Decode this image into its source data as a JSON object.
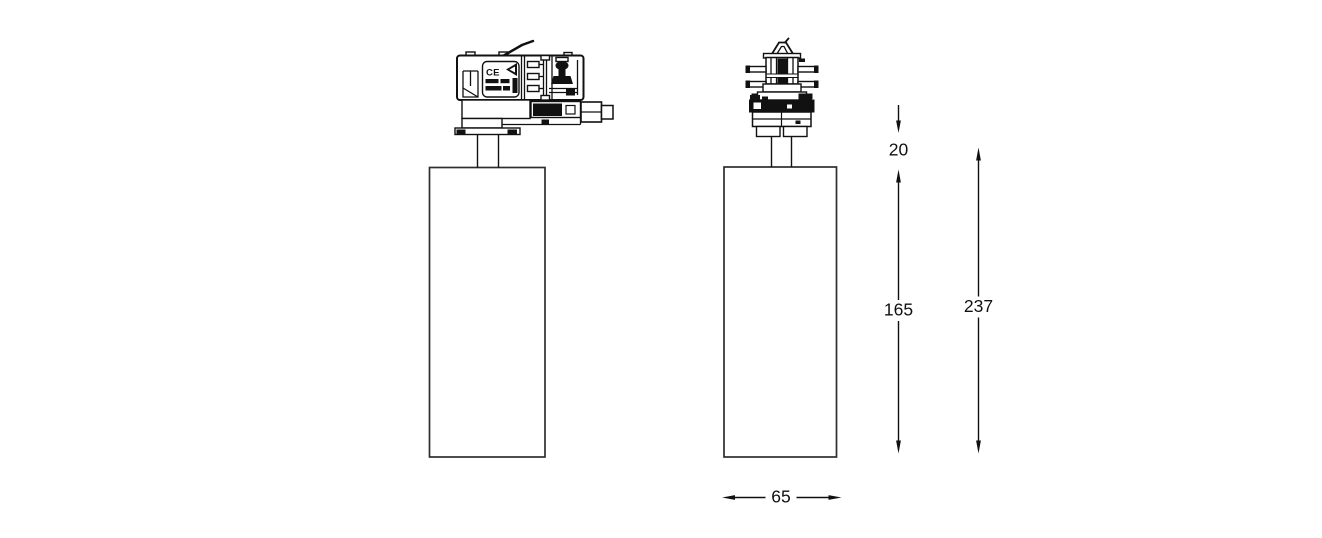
{
  "colors": {
    "background": "#ffffff",
    "line": "#111111",
    "body_outline": "#2e2e2e"
  },
  "labels": {
    "ce_mark": "CE"
  },
  "dimensions": {
    "adapter_height": "20",
    "body_height": "165",
    "total_height": "237",
    "body_width": "65"
  }
}
